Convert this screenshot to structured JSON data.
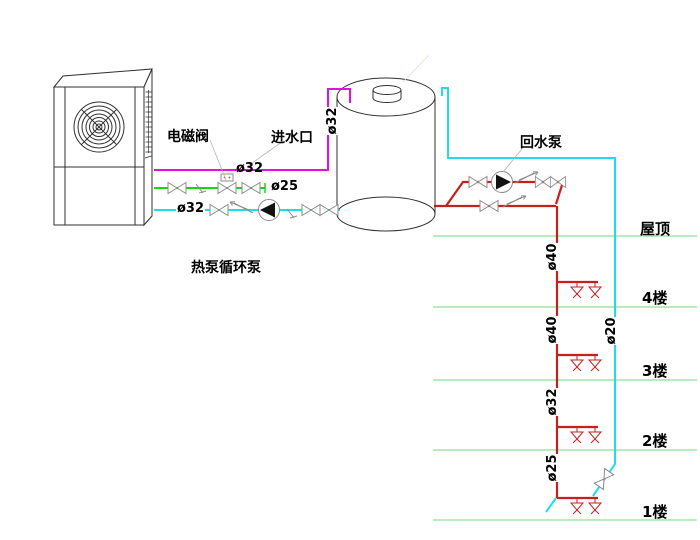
{
  "labels": {
    "solenoid_valve": "电磁阀",
    "water_inlet": "进水口",
    "return_pump": "回水泵",
    "circulation_pump": "热泵循环泵"
  },
  "floors": {
    "roof": "屋顶",
    "f4": "4楼",
    "f3": "3楼",
    "f2": "2楼",
    "f1": "1楼"
  },
  "pipe_sizes": {
    "hp_return": "ø32",
    "hp_supply": "ø32",
    "supply_riser": "ø32",
    "makeup": "ø25",
    "riser_roof_f4": "ø40",
    "riser_f4_f3": "ø40",
    "riser_f3_f2": "ø32",
    "riser_f2_f1": "ø25",
    "return_riser": "ø20"
  },
  "colors": {
    "inlet_pipe": "#e211e2",
    "makeup_pipe": "#17d417",
    "loop_pipe": "#20dcea",
    "hot_water_pipe": "#c6201e",
    "floor_line": "#8fe093",
    "valve_outline": "#8c8c8c",
    "drawing_outline": "#303030",
    "leader_line": "#b5b5b5"
  }
}
